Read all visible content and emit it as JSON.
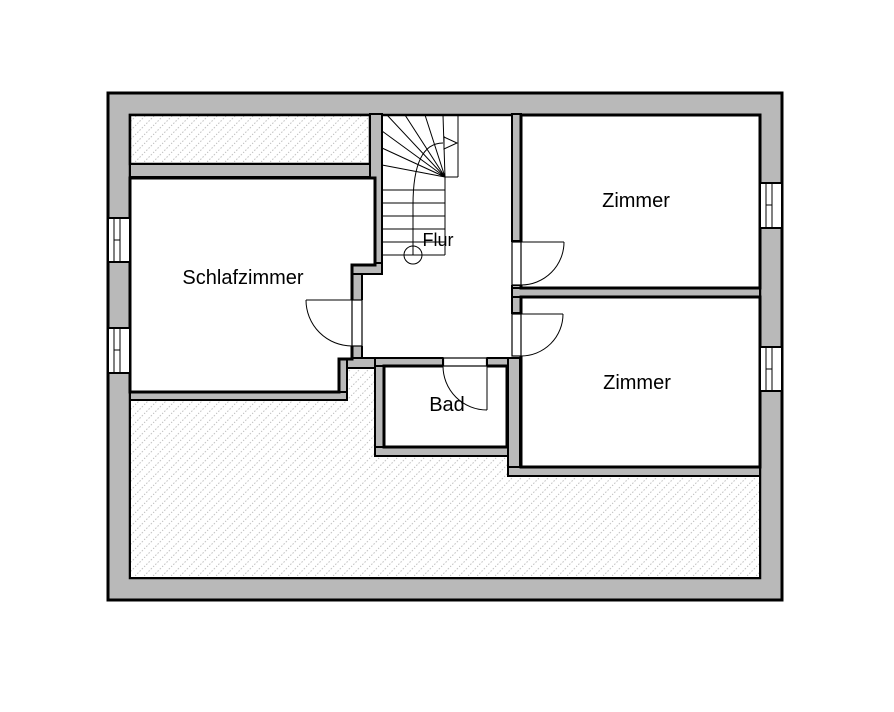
{
  "plan": {
    "rooms": {
      "schlafzimmer": {
        "label": "Schlafzimmer"
      },
      "zimmer_top": {
        "label": "Zimmer"
      },
      "zimmer_bottom": {
        "label": "Zimmer"
      },
      "bad": {
        "label": "Bad"
      },
      "flur": {
        "label": "Flur"
      }
    },
    "colors": {
      "wall_fill": "#b9b9b9",
      "line": "#000000",
      "hatch_line": "#c3c3c3"
    }
  }
}
